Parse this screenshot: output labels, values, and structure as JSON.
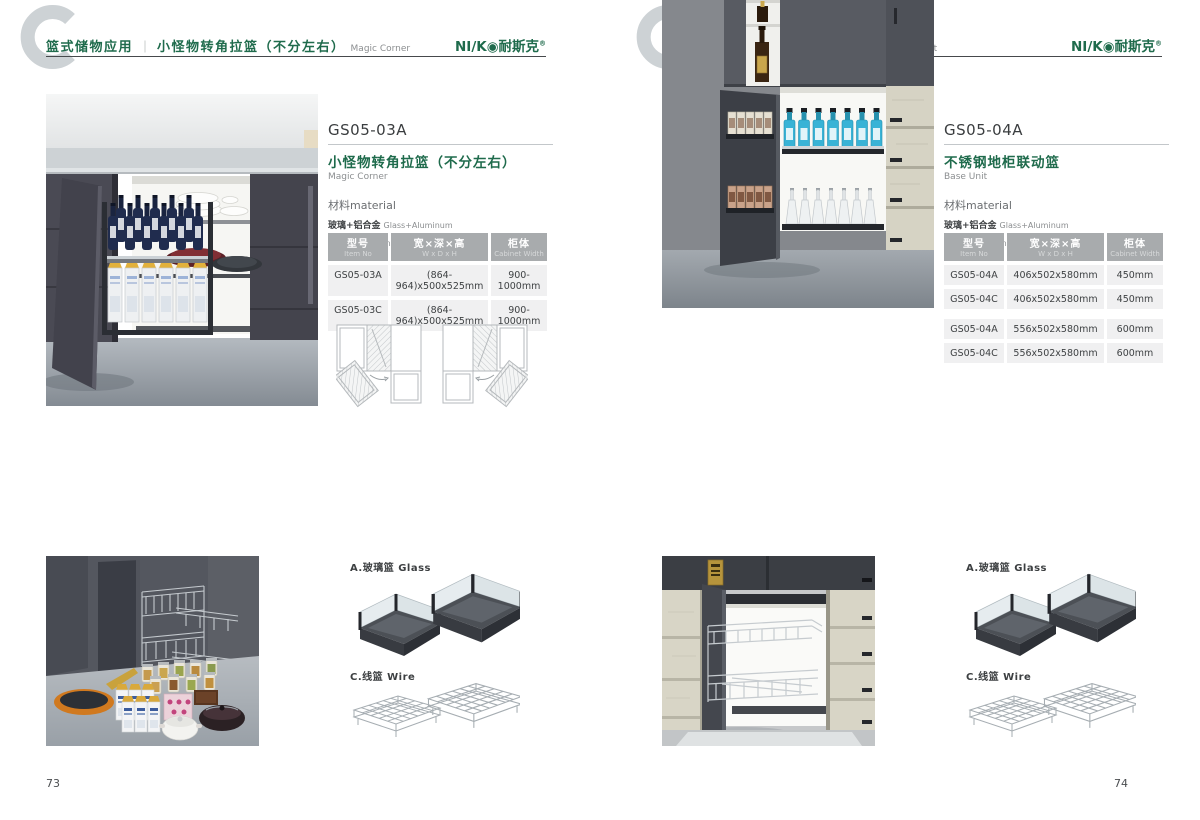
{
  "brand": {
    "logo_text": "NI/K◉耐斯克",
    "logo_reg": "®"
  },
  "left": {
    "page_number": "73",
    "header": {
      "category": "篮式储物应用",
      "divider": "｜",
      "title_cn": "小怪物转角拉篮（不分左右）",
      "title_en": "Magic Corner"
    },
    "product": {
      "model": "GS05-03A",
      "name_cn": "小怪物转角拉篮（不分左右）",
      "name_en": "Magic Corner",
      "material_title": "材料material",
      "materials": [
        {
          "cn": "玻璃+铝合金",
          "en": "Glass+Aluminum"
        },
        {
          "cn": "不锈钢/铁",
          "en": "Stainless SteeL/Iron"
        }
      ]
    },
    "table": {
      "headers": [
        {
          "cn": "型号",
          "en": "Item No"
        },
        {
          "cn": "宽×深×高",
          "en": "W x D x H"
        },
        {
          "cn": "柜体",
          "en": "Cabinet Width"
        }
      ],
      "rows": [
        [
          "GS05-03A",
          "(864-964)x500x525mm",
          "900-1000mm"
        ],
        [
          "GS05-03C",
          "(864-964)x500x525mm",
          "900-1000mm"
        ]
      ]
    },
    "accessories": {
      "glass_label": "A.玻璃篮 Glass",
      "wire_label": "C.线篮 Wire"
    }
  },
  "right": {
    "page_number": "74",
    "header": {
      "category": "篮式储物应用",
      "divider": "｜",
      "title_cn": "不锈钢地柜联动篮",
      "title_en": "Base Unit"
    },
    "product": {
      "model": "GS05-04A",
      "name_cn": "不锈钢地柜联动篮",
      "name_en": "Base Unit",
      "material_title": "材料material",
      "materials": [
        {
          "cn": "玻璃+铝合金",
          "en": "Glass+Aluminum"
        },
        {
          "cn": "不锈钢/铁",
          "en": "Stainless SteeL/Iron"
        }
      ]
    },
    "table": {
      "headers": [
        {
          "cn": "型号",
          "en": "Item No"
        },
        {
          "cn": "宽×深×高",
          "en": "W x D x H"
        },
        {
          "cn": "柜体",
          "en": "Cabinet Width"
        }
      ],
      "rows": [
        [
          "GS05-04A",
          "406x502x580mm",
          "450mm"
        ],
        [
          "GS05-04C",
          "406x502x580mm",
          "450mm"
        ],
        [
          "GS05-04A",
          "556x502x580mm",
          "600mm"
        ],
        [
          "GS05-04C",
          "556x502x580mm",
          "600mm"
        ]
      ]
    },
    "accessories": {
      "glass_label": "A.玻璃篮 Glass",
      "wire_label": "C.线篮 Wire"
    }
  }
}
